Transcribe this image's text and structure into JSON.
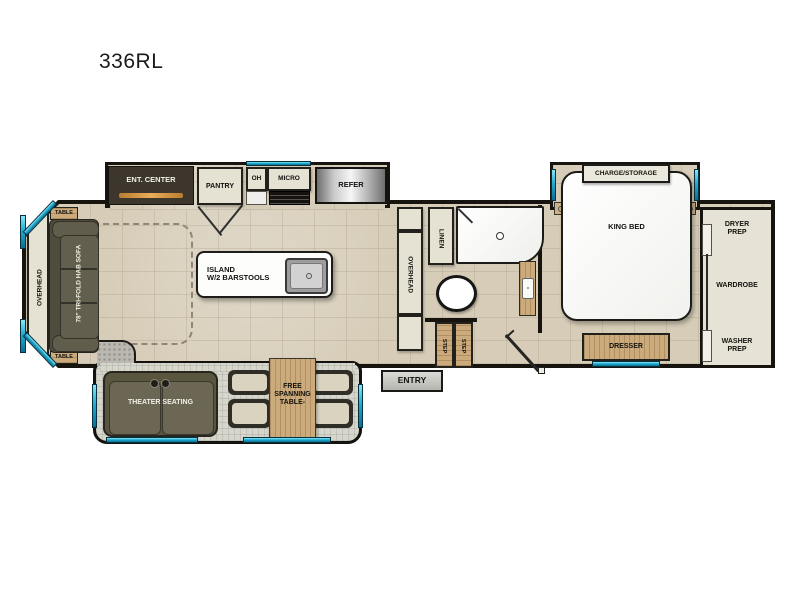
{
  "title": "336RL",
  "colors": {
    "wall": "#17140f",
    "floor_tile": "#d6ccb7",
    "carpet": "#d6d6cd",
    "window_accent": "#2cb6dc",
    "wood": "#cbaa7b",
    "cabinet": "#e5e1d3",
    "sofa": "#5d5947",
    "fireplace_accent": "#d18a3a",
    "refrigerator": "#c9c9c9"
  },
  "rooms": {
    "kitchen_slide": {
      "ent_center": "ENT. CENTER",
      "pantry": "PANTRY",
      "oh": "OH",
      "micro": "MICRO",
      "refer": "REFER"
    },
    "living": {
      "overhead": "OVERHEAD",
      "table_top": "TABLE",
      "table_bottom": "TABLE",
      "sofa": "78\" TRI-FOLD HAB SOFA",
      "island_line1": "ISLAND",
      "island_line2": "W/2 BARSTOOLS"
    },
    "dinette_slide": {
      "theater": "THEATER SEATING",
      "table_line1": "FREE",
      "table_line2": "SPANNING",
      "table_line3": "TABLE-"
    },
    "bath": {
      "overhead": "OVERHEAD",
      "linen": "LINEN",
      "step_left": "STEP",
      "step_right": "STEP"
    },
    "entry": {
      "label": "ENTRY"
    },
    "bedroom": {
      "charge_storage": "CHARGE/STORAGE",
      "king_bed": "KING BED",
      "dresser": "DRESSER"
    },
    "closet": {
      "dryer": "DRYER PREP",
      "wardrobe": "WARDROBE",
      "washer": "WASHER PREP"
    }
  }
}
